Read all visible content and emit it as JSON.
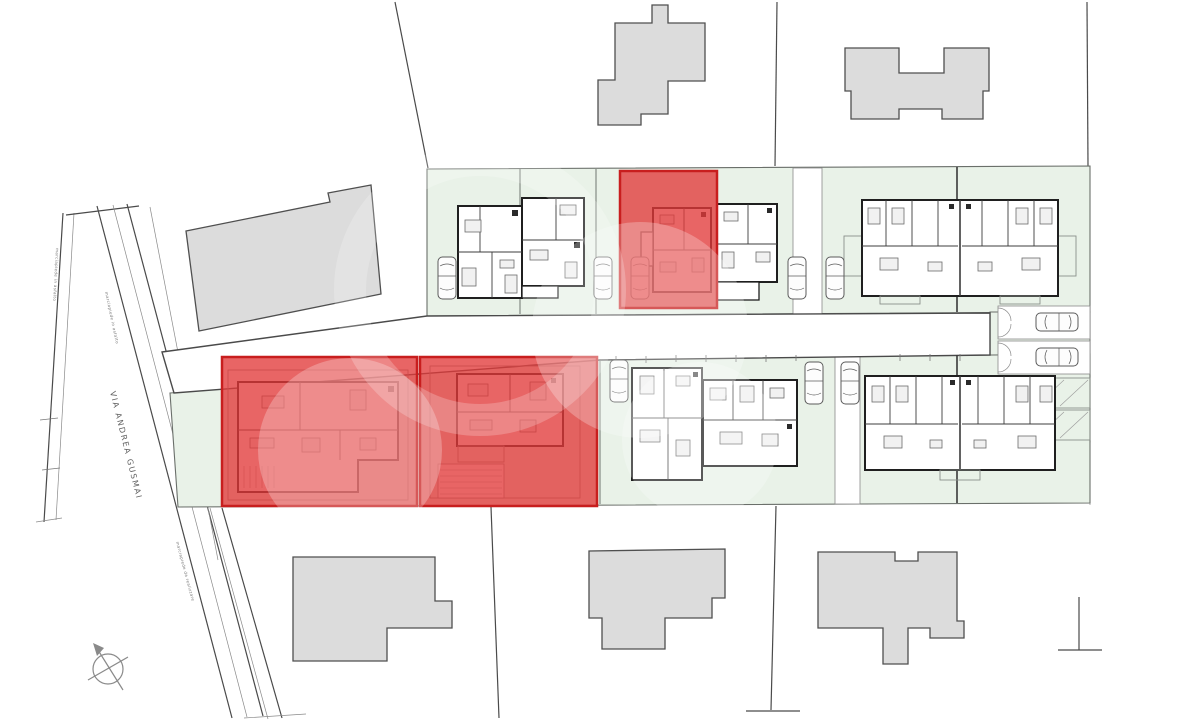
{
  "colors": {
    "highlight": "#e23a3a",
    "highlight_border": "#c81e1e",
    "plot_green": "#e9f2e8",
    "building_gray": "#dcdcdc",
    "line": "#4a4a4a"
  },
  "streets": {
    "main": "VIA ANDREA GUSMAI"
  },
  "road_annotations": {
    "sidewalk_upper": "marciapiede in asfalto",
    "sidewalk_lower": "marciapiede da realizzare",
    "left_boundary": "marciapiede in asfalto"
  },
  "plots": {
    "highlighted_count": 3
  },
  "icons": {
    "compass": "north-arrow-compass",
    "car": "parked-car-plan-symbol"
  }
}
